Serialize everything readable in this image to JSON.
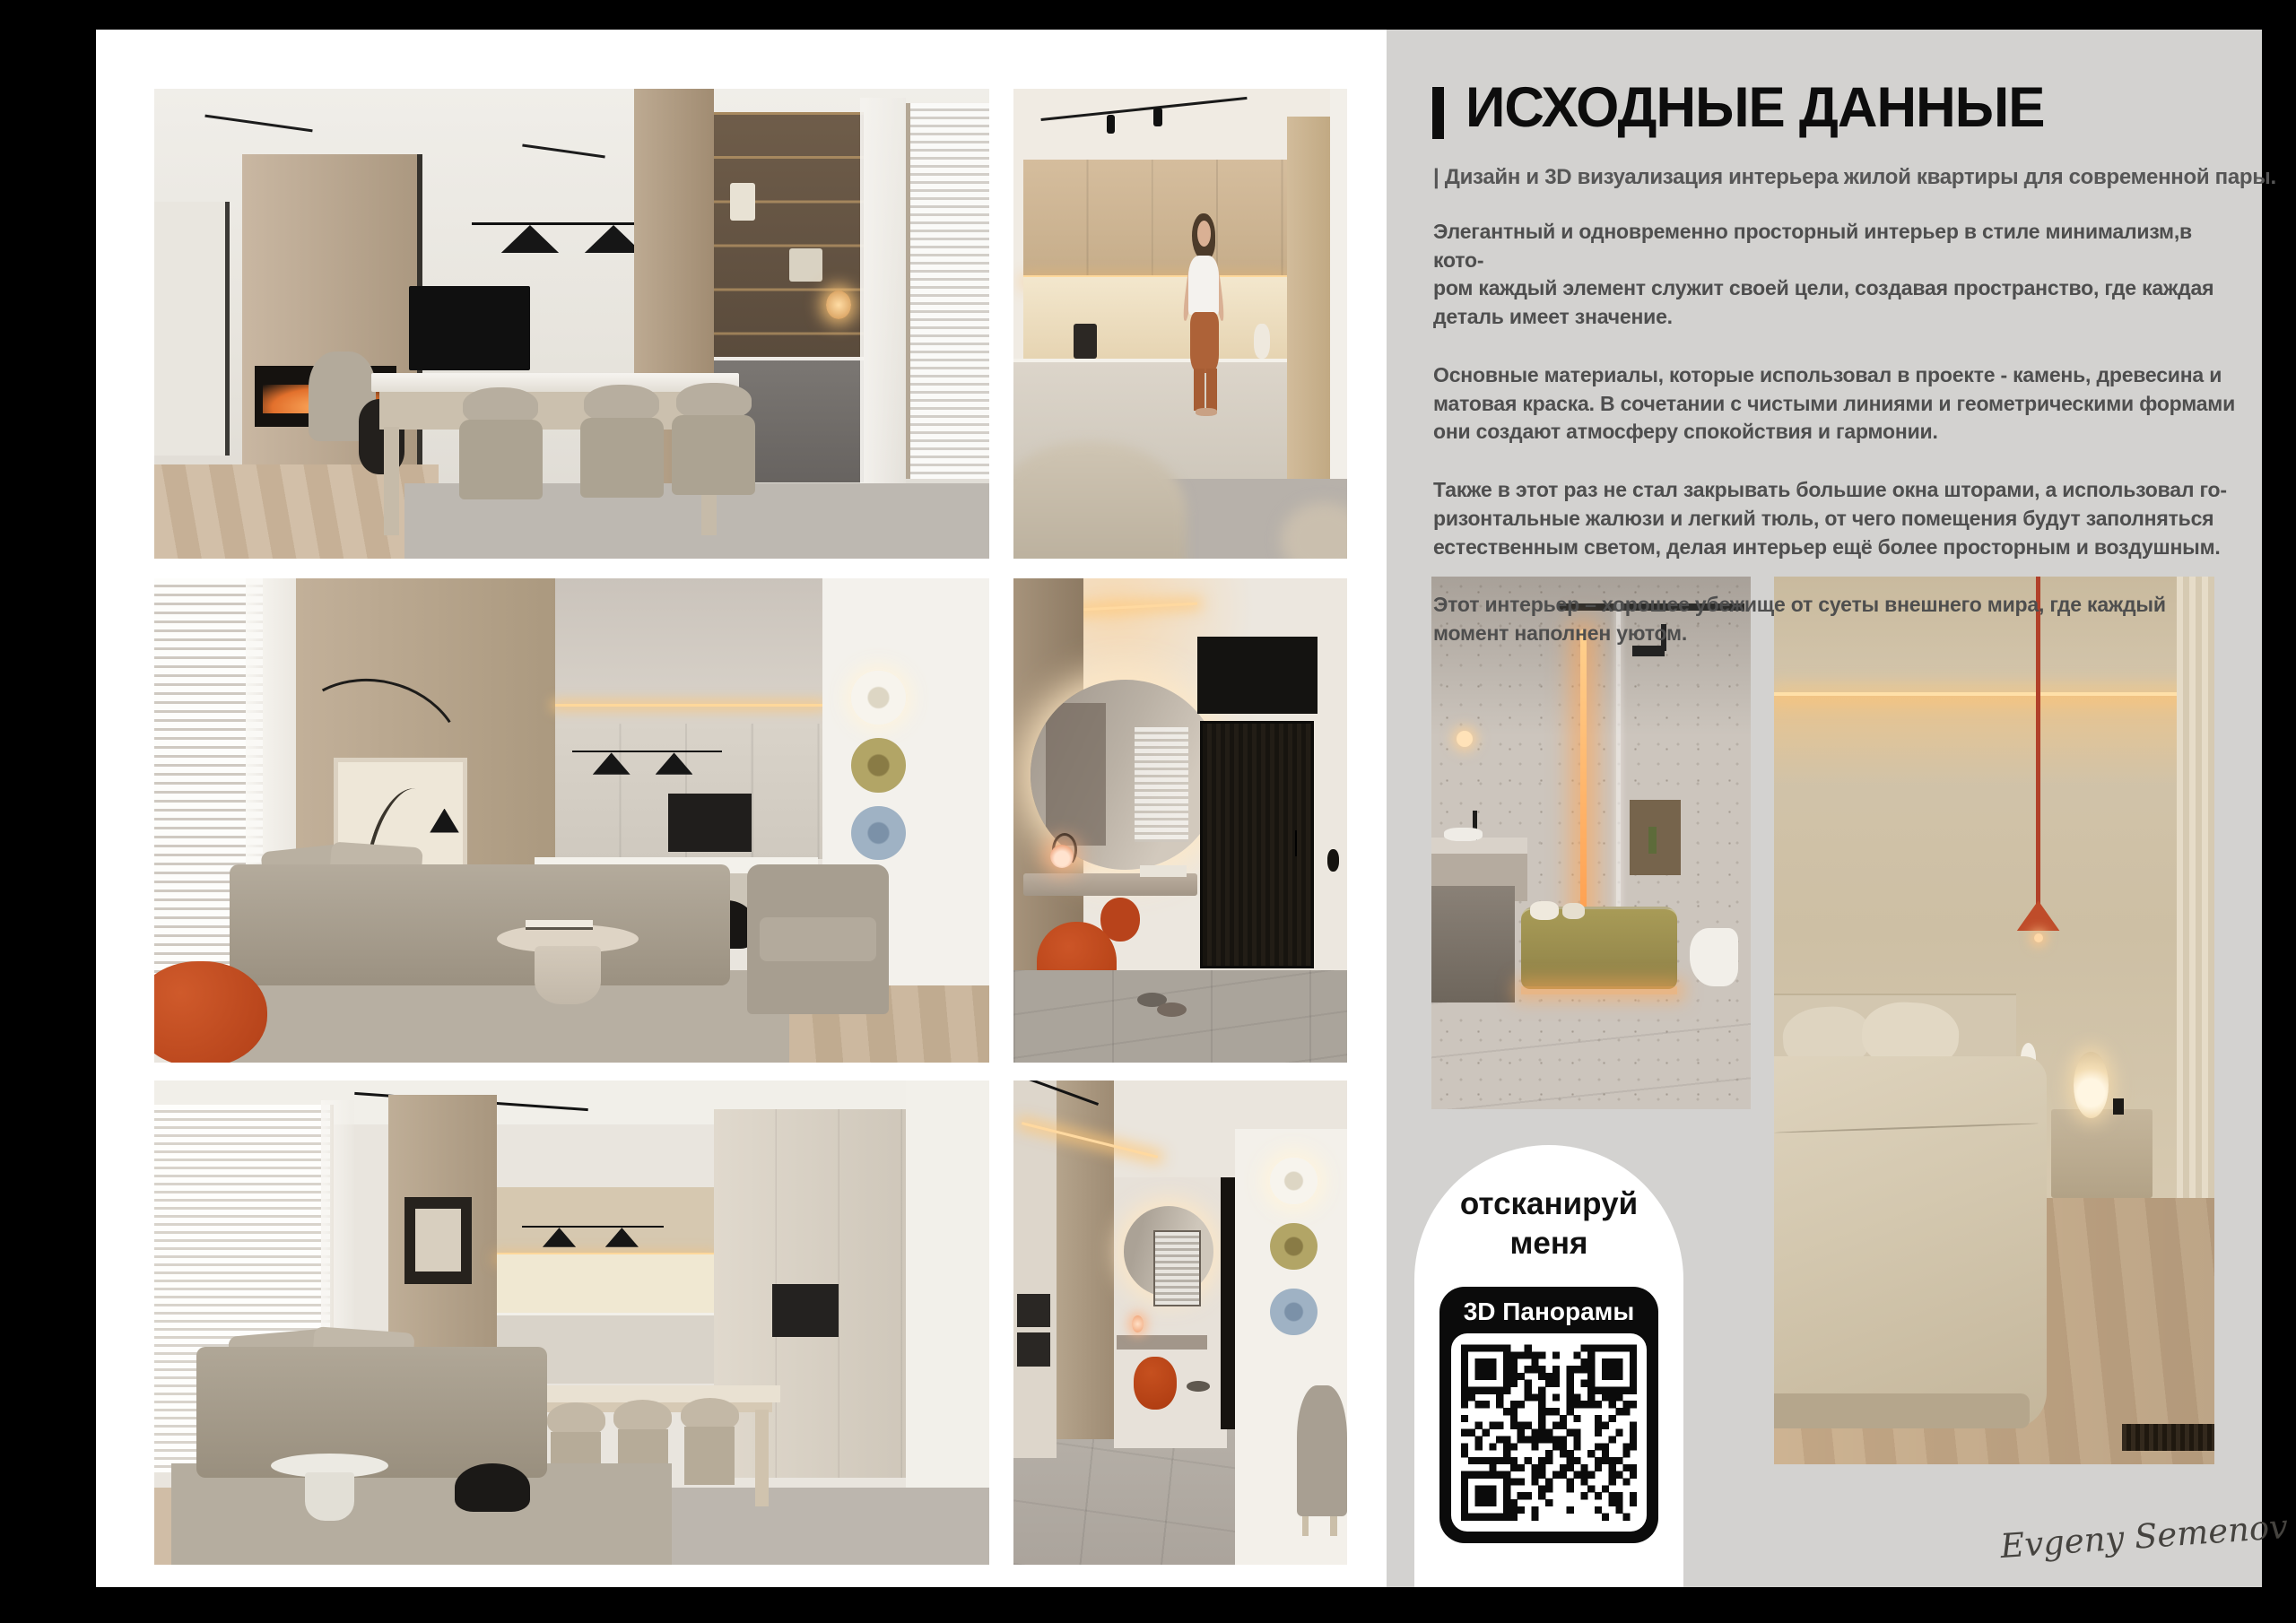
{
  "page": {
    "background": "#000000",
    "board_bg": "#ffffff",
    "panel_bg": "#d3d2d0",
    "accent_red": "#bf4a20"
  },
  "header": {
    "title": "ИСХОДНЫЕ ДАННЫЕ",
    "subtitle": "| Дизайн и 3D визуализация интерьера жилой квартиры для современной пары."
  },
  "body_text": {
    "paragraphs": [
      "Элегантный и одновременно просторный интерьер в стиле минимализм,в кото-\nром каждый элемент служит своей цели, создавая пространство, где каждая\nдеталь имеет значение.",
      "Основные материалы, которые использовал в проекте - камень, древесина и\nматовая краска. В сочетании с чистыми линиями и геометрическими формами\nони создают атмосферу спокойствия и гармонии.",
      "Также в этот раз не стал закрывать большие окна шторами, а использовал го-\nризонтальные жалюзи и легкий тюль, от чего помещения будут заполняться\nестественным светом, делая интерьер ещё более просторным и воздушным.",
      "Этот интерьер – хорошее убежище от суеты внешнего мира, где каждый\nмомент наполнен уютом."
    ]
  },
  "scan_badge": {
    "label": "отсканируй\nменя",
    "qr_title": "3D Панорамы"
  },
  "signature": "Evgeny Semenov"
}
